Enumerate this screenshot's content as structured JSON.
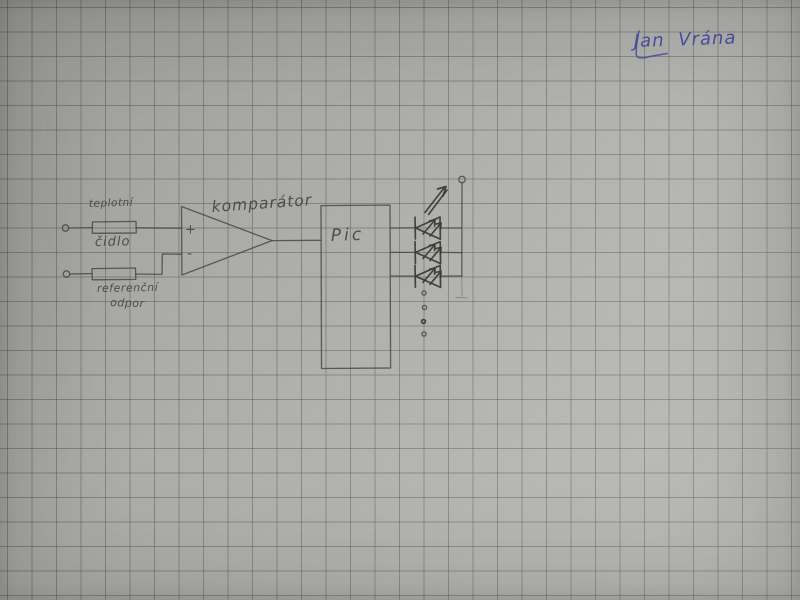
{
  "paper": {
    "background_color": "#b3b3af",
    "grid_color": "#5c605a",
    "grid_spacing_px": 24.5,
    "pencil_color": "#45443e"
  },
  "signature": {
    "text": "Jan Vrána",
    "ink_color": "#4b51a8"
  },
  "schematic": {
    "temperature_sensor": {
      "line1": "teplotní",
      "line2": "čidlo"
    },
    "reference_resistor": {
      "line1": "referenční",
      "line2": "odpor"
    },
    "comparator": {
      "label": "komparátor",
      "plus_input": "+",
      "minus_input": "-"
    },
    "pic": {
      "label": "Pic"
    },
    "leds_drawn": 3,
    "continuation_dots": 4
  }
}
